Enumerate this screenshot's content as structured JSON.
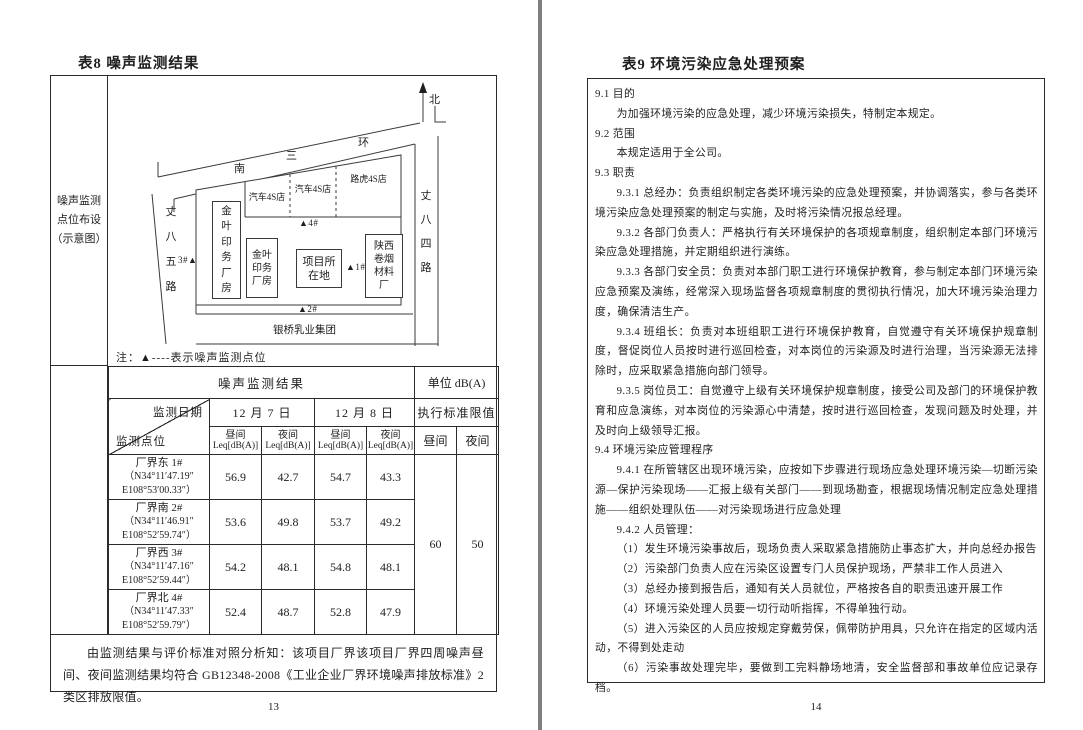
{
  "left_page": {
    "title": "表8 噪声监测结果",
    "page_number": "13",
    "map": {
      "label_lines": [
        "噪声监测",
        "点位布设",
        "（示意图）"
      ],
      "north_label": "北",
      "road_top_chars": [
        "南",
        "三",
        "环"
      ],
      "road_left": "丈八五路",
      "road_right": "丈八四路",
      "shops": [
        "汽车4S店",
        "汽车4S店",
        "路虎4S店"
      ],
      "buildings": {
        "jinye_tall": "金叶印务厂房",
        "jinye_small": "金叶印务厂房",
        "project": "项目所在地",
        "shaanxi_tobacco": "陕西卷烟材料厂",
        "dairy": "银桥乳业集团"
      },
      "points": {
        "p1": "▲1#",
        "p2": "▲2#",
        "p3": "3#▲",
        "p4": "▲4#"
      },
      "note": "注：▲----表示噪声监测点位"
    },
    "table": {
      "title": "噪声监测结果",
      "unit": "单位 dB(A)",
      "diagonal_top": "监测日期",
      "diagonal_bottom": "监测点位",
      "date_1": "12 月 7 日",
      "date_2": "12 月 8 日",
      "limit_header": "执行标准限值",
      "day_label": "昼间",
      "night_label": "夜间",
      "leq_label": "Leq[dB(A)]",
      "rows": [
        {
          "name": "厂界东 1#",
          "coord_line1": "（N34°11′47.19″",
          "coord_line2": "E108°53′00.33″）",
          "day1": "56.9",
          "night1": "42.7",
          "day2": "54.7",
          "night2": "43.3"
        },
        {
          "name": "厂界南 2#",
          "coord_line1": "（N34°11′46.91″",
          "coord_line2": "E108°52′59.74″）",
          "day1": "53.6",
          "night1": "49.8",
          "day2": "53.7",
          "night2": "49.2"
        },
        {
          "name": "厂界西 3#",
          "coord_line1": "（N34°11′47.16″",
          "coord_line2": "E108°52′59.44″）",
          "day1": "54.2",
          "night1": "48.1",
          "day2": "54.8",
          "night2": "48.1"
        },
        {
          "name": "厂界北 4#",
          "coord_line1": "（N34°11′47.33″",
          "coord_line2": "E108°52′59.79″）",
          "day1": "52.4",
          "night1": "48.7",
          "day2": "52.8",
          "night2": "47.9"
        }
      ],
      "limit_day": "60",
      "limit_night": "50"
    },
    "analysis": "由监测结果与评价标准对照分析知：该项目厂界该项目厂界四周噪声昼间、夜间监测结果均符合 GB12348-2008《工业企业厂界环境噪声排放标准》2 类区排放限值。"
  },
  "right_page": {
    "title": "表9 环境污染应急处理预案",
    "page_number": "14",
    "paragraphs": [
      {
        "text": "9.1 目的"
      },
      {
        "text": "为加强环境污染的应急处理，减少环境污染损失，特制定本规定。"
      },
      {
        "text": "9.2 范围"
      },
      {
        "text": "本规定适用于全公司。"
      },
      {
        "text": "9.3 职责"
      },
      {
        "text": "9.3.1 总经办：负责组织制定各类环境污染的应急处理预案，并协调落实，参与各类环境污染应急处理预案的制定与实施，及时将污染情况报总经理。"
      },
      {
        "text": "9.3.2 各部门负责人：严格执行有关环境保护的各项规章制度，组织制定本部门环境污染应急处理措施，并定期组织进行演练。"
      },
      {
        "text": "9.3.3 各部门安全员：负责对本部门职工进行环境保护教育，参与制定本部门环境污染应急预案及演练，经常深入现场监督各项规章制度的贯彻执行情况，加大环境污染治理力度，确保清洁生产。"
      },
      {
        "text": "9.3.4 班组长：负责对本班组职工进行环境保护教育，自觉遵守有关环境保护规章制度，督促岗位人员按时进行巡回检查，对本岗位的污染源及时进行治理，当污染源无法排除时，应采取紧急措施向部门领导。"
      },
      {
        "text": "9.3.5 岗位员工：自觉遵守上级有关环境保护规章制度，接受公司及部门的环境保护教育和应急演练，对本岗位的污染源心中清楚，按时进行巡回检查，发现问题及时处理，并及时向上级领导汇报。"
      },
      {
        "text": "9.4 环境污染应管理程序"
      },
      {
        "text": "9.4.1 在所管辖区出现环境污染，应按如下步骤进行现场应急处理环境污染—切断污染源—保护污染现场——汇报上级有关部门——到现场勘查，根据现场情况制定应急处理措施——组织处理队伍——对污染现场进行应急处理"
      },
      {
        "text": "9.4.2 人员管理："
      },
      {
        "text": "（1）发生环境污染事故后，现场负责人采取紧急措施防止事态扩大，并向总经办报告"
      },
      {
        "text": "（2）污染部门负责人应在污染区设置专门人员保护现场，严禁非工作人员进入"
      },
      {
        "text": "（3）总经办接到报告后，通知有关人员就位，严格按各自的职责迅速开展工作"
      },
      {
        "text": "（4）环境污染处理人员要一切行动听指挥，不得单独行动。"
      },
      {
        "text": "（5）进入污染区的人员应按规定穿戴劳保，佩带防护用具，只允许在指定的区域内活动，不得到处走动"
      },
      {
        "text": "（6）污染事故处理完毕，要做到工完料静场地清，安全监督部和事故单位应记录存档。"
      }
    ]
  }
}
